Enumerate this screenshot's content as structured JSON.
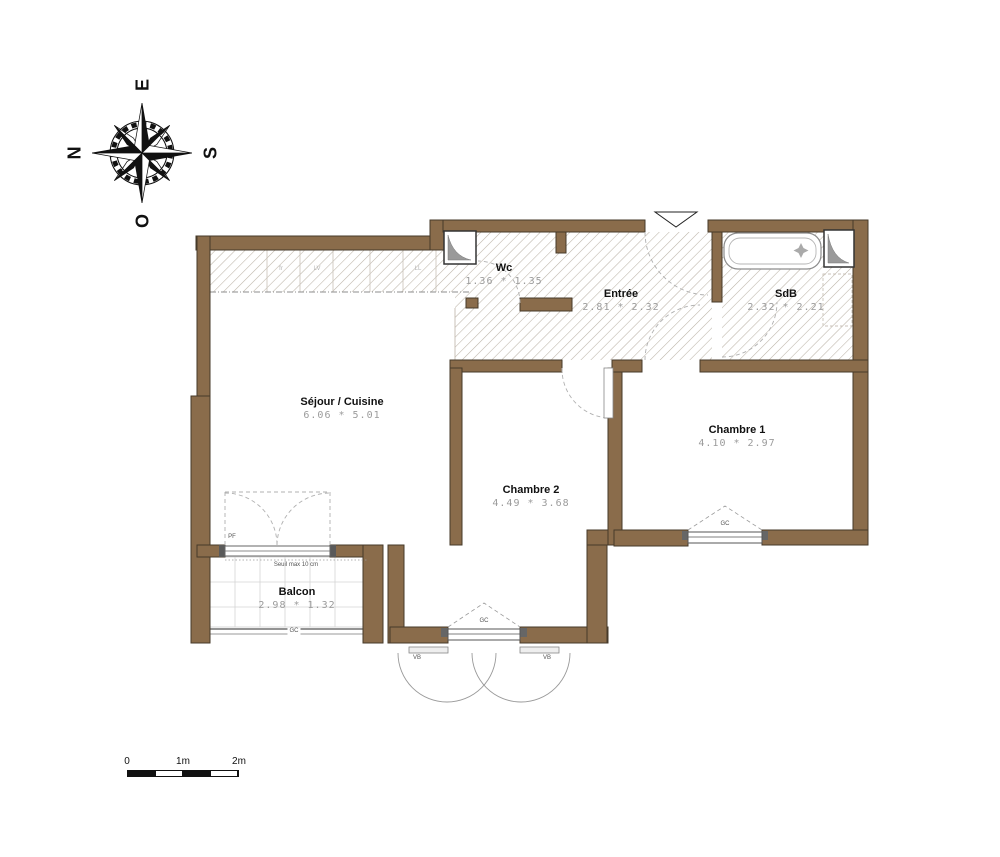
{
  "compass": {
    "top": "E",
    "left": "N",
    "right": "S",
    "bottom": "O"
  },
  "rooms": {
    "sejour": {
      "name": "Séjour / Cuisine",
      "dims": "6.06 * 5.01"
    },
    "wc": {
      "name": "Wc",
      "dims": "1.36 * 1.35"
    },
    "entree": {
      "name": "Entrée",
      "dims": "2.81 * 2.32"
    },
    "sdb": {
      "name": "SdB",
      "dims": "2.32 * 2.21"
    },
    "chambre1": {
      "name": "Chambre 1",
      "dims": "4.10 * 2.97"
    },
    "chambre2": {
      "name": "Chambre 2",
      "dims": "4.49 * 3.68"
    },
    "balcon": {
      "name": "Balcon",
      "dims": "2.98 * 1.32"
    }
  },
  "annotations": {
    "seuil": "Seuil max 10 cm",
    "pf": "PF",
    "gc": "GC",
    "vb": "VB",
    "appliances": [
      "fr",
      "LV",
      "LL"
    ]
  },
  "scale_bar": {
    "labels": [
      "0",
      "1m",
      "2m"
    ]
  },
  "colors": {
    "wall": "#8a6c4b",
    "wall_outline": "#463a2a",
    "hatch": "#bcb4a8",
    "fixture": "#8c8c8c",
    "duct": "#9a9a9a",
    "swing": "#b0b0b0"
  }
}
